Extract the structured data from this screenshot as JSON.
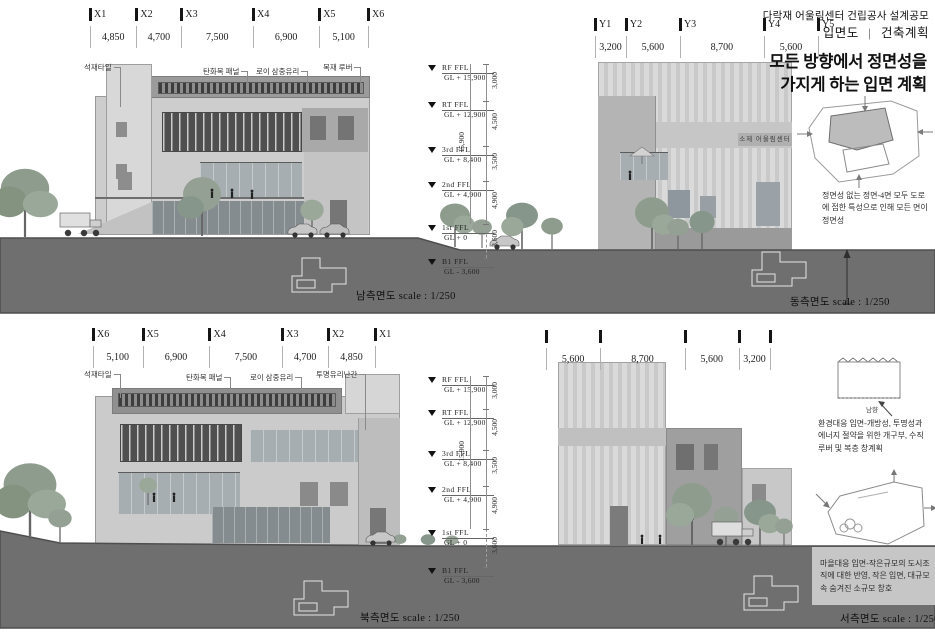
{
  "title_block": {
    "project": "다락재 어울림센터 건립공사 설계공모",
    "sheet": "입면도",
    "divider": "|",
    "category": "건축계획"
  },
  "headline": {
    "line1": "모든 방향에서 정면성을",
    "line2": "가지게 하는 입면 계획"
  },
  "panels": {
    "south": {
      "caption": "남측면도 scale : 1/250",
      "grid_labels": [
        "X1",
        "X2",
        "X3",
        "X4",
        "X5",
        "X6"
      ],
      "dims": [
        "4,850",
        "4,700",
        "7,500",
        "6,900",
        "5,100"
      ],
      "material_notes": [
        "석재타일",
        "탄화목 패널",
        "로이 삼중유리",
        "목재 루버"
      ]
    },
    "east": {
      "caption": "동측면도 scale : 1/250",
      "grid_labels": [
        "Y1",
        "Y2",
        "Y3",
        "Y4",
        "Y5"
      ],
      "dims": [
        "3,200",
        "5,600",
        "8,700",
        "5,600"
      ],
      "sign": "소제 어울림센터"
    },
    "north": {
      "caption": "북측면도 scale : 1/250",
      "grid_labels": [
        "X6",
        "X5",
        "X4",
        "X3",
        "X2",
        "X1"
      ],
      "dims": [
        "5,100",
        "6,900",
        "7,500",
        "4,700",
        "4,850"
      ],
      "material_notes": [
        "석재타일",
        "탄화목 패널",
        "로이 삼중유리",
        "투명유리난간"
      ]
    },
    "west": {
      "caption": "서측면도 scale : 1/250",
      "grid_labels": [],
      "dims": [
        "5,600",
        "8,700",
        "5,600",
        "3,200"
      ]
    }
  },
  "levels": [
    {
      "name": "RF  FFL",
      "gl": "GL  + 15,900"
    },
    {
      "name": "RT  FFL",
      "gl": "GL  + 12,900"
    },
    {
      "name": "3rd  FFL",
      "gl": "GL  + 8,400"
    },
    {
      "name": "2nd  FFL",
      "gl": "GL  + 4,900"
    },
    {
      "name": "1st  FFL",
      "gl": "GL  + 0"
    },
    {
      "name": "B1  FFL",
      "gl": "GL  - 3,600"
    }
  ],
  "height_dims": [
    "3,000",
    "4,500",
    "3,500",
    "4,900"
  ],
  "below_ground_dim": "3,600",
  "total_height": "15,900",
  "annotations": {
    "frontality": "정면성 없는 정면-4면 모두 도로에 접한 특성으로 인해 모든 면이 정면성",
    "environment": "환경대응 입면-개방성, 투명성과 에너지 절약을 위한 개구부, 수직루버 및 복층 창계획",
    "village": "마을대응 입면-작은규모의 도시조직에 대한 반영, 작은 입면, 대규모 속 숨겨진 소규모 창호",
    "sun": "남향"
  },
  "colors": {
    "terrain": "#6f6f6f",
    "terrain_edge": "#4e4e4e",
    "tree": "#93a093",
    "accent_dark": "#3d3d3d"
  }
}
